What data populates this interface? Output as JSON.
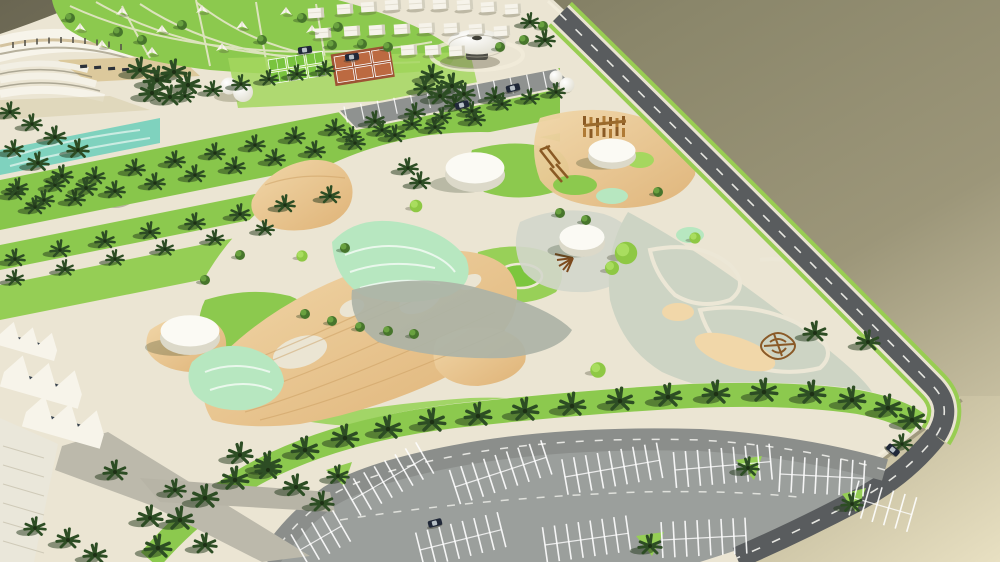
{
  "scene": {
    "description": "Aerial perspective 3D architectural rendering of a desert public park master plan model in bright daylight, viewed from above at an angle, sitting on an olive-tan ground plane",
    "regions": {
      "top_left": "curved white grandstand building beside a contoured lawn hill dotted with small white shade tents and crossing cream footpaths",
      "top_center": "rows of small white pitched-roof cottages, a white saucer-shaped pavilion on a dark drum base, terracotta tennis courts, green five-a-side pitches, white dome tanks and a diagonal parking strip lined with palms",
      "left": "diagonal palm-grove lawn bands separated by cream paths, a teal water channel, a gray boulder, white folded-plate (sawtooth) canopies and gray promenade paths",
      "center": "organic plaza of timber decking, cream gravel, mint-green marbled planting, gray granite bands, bright lawns, four white cylindrical drum pavilions, topiary balls and tree rows; wooden playground equipment on a timber deck",
      "right": "sage-gray garden triangle with cream swirl paths, sand patches and a brown twig sculpture, bordered by a dark asphalt road with dashed white lines and a green verge",
      "bottom": "sweeping double allee of palm trees above a perimeter road and a large gray parking lot with white bay markings and a few dark cars",
      "background": "plain olive-khaki surface, lighter cream toward the bottom-right corner beyond the model edge"
    },
    "objects": [
      "grandstand-arc",
      "contour-hill",
      "shade-tents",
      "white-cottages",
      "saucer-pavilion",
      "tennis-courts",
      "mini-football-pitches",
      "dome-tanks",
      "parking-strip",
      "palm-grove",
      "teal-channel",
      "boulder",
      "sawtooth-canopies",
      "plaza-wood-deck",
      "mint-planting",
      "granite-band",
      "drum-pavilions",
      "topiary-balls",
      "playground-climber",
      "pergola",
      "twig-sculpture",
      "swirl-garden",
      "palm-allee",
      "perimeter-road",
      "parking-lot",
      "cars"
    ],
    "cars_visible": 6,
    "drum_pavilions_visible": 4
  },
  "palette": {
    "bg_olive_dark": "#6a6652",
    "bg_olive": "#8a866a",
    "bg_khaki": "#9c9679",
    "bg_cream": "#e4dbbc",
    "wedge_mid": "#b3ab8b",
    "wedge_light": "#e8e0c2",
    "site": "#ebe5d3",
    "rim": "#f2ecdb",
    "lawn": "#8cc94e",
    "lawn_light": "#a5d75f",
    "lawn_mid": "#95ce55",
    "grove": "#88c64b",
    "teal": "#7fd2be",
    "mint": "#b7e7c0",
    "wood_hi": "#f1d7a9",
    "wood": "#dfb377",
    "wood_grain": "#c89a5c",
    "granite": "#adb3a6",
    "concrete": "#d3d6cb",
    "sage": "#cdd4c4",
    "asphalt": "#595c5e",
    "road_mid": "#8b8e8b",
    "parking": "#9b9f9c",
    "strip_lot": "#8f9290",
    "path_gray": "#bcb9ab",
    "white_struct": "#f7f4ea",
    "white_shade": "#dcd9c9",
    "glass": "#39434e",
    "terracotta": "#bc6a41",
    "pitch_green": "#79c43e",
    "play_brown": "#b07b35",
    "play_brown_dark": "#8a5a24",
    "twig": "#8a5a28",
    "palm": "#2d4d24",
    "palm_shadow": "#22381a",
    "tree": "#47752c",
    "tree_light": "#69a13f",
    "topiary": "#8ec844",
    "car_body": "#202838",
    "boulder": "#b9b3a2",
    "contour": "#f0ead8"
  }
}
